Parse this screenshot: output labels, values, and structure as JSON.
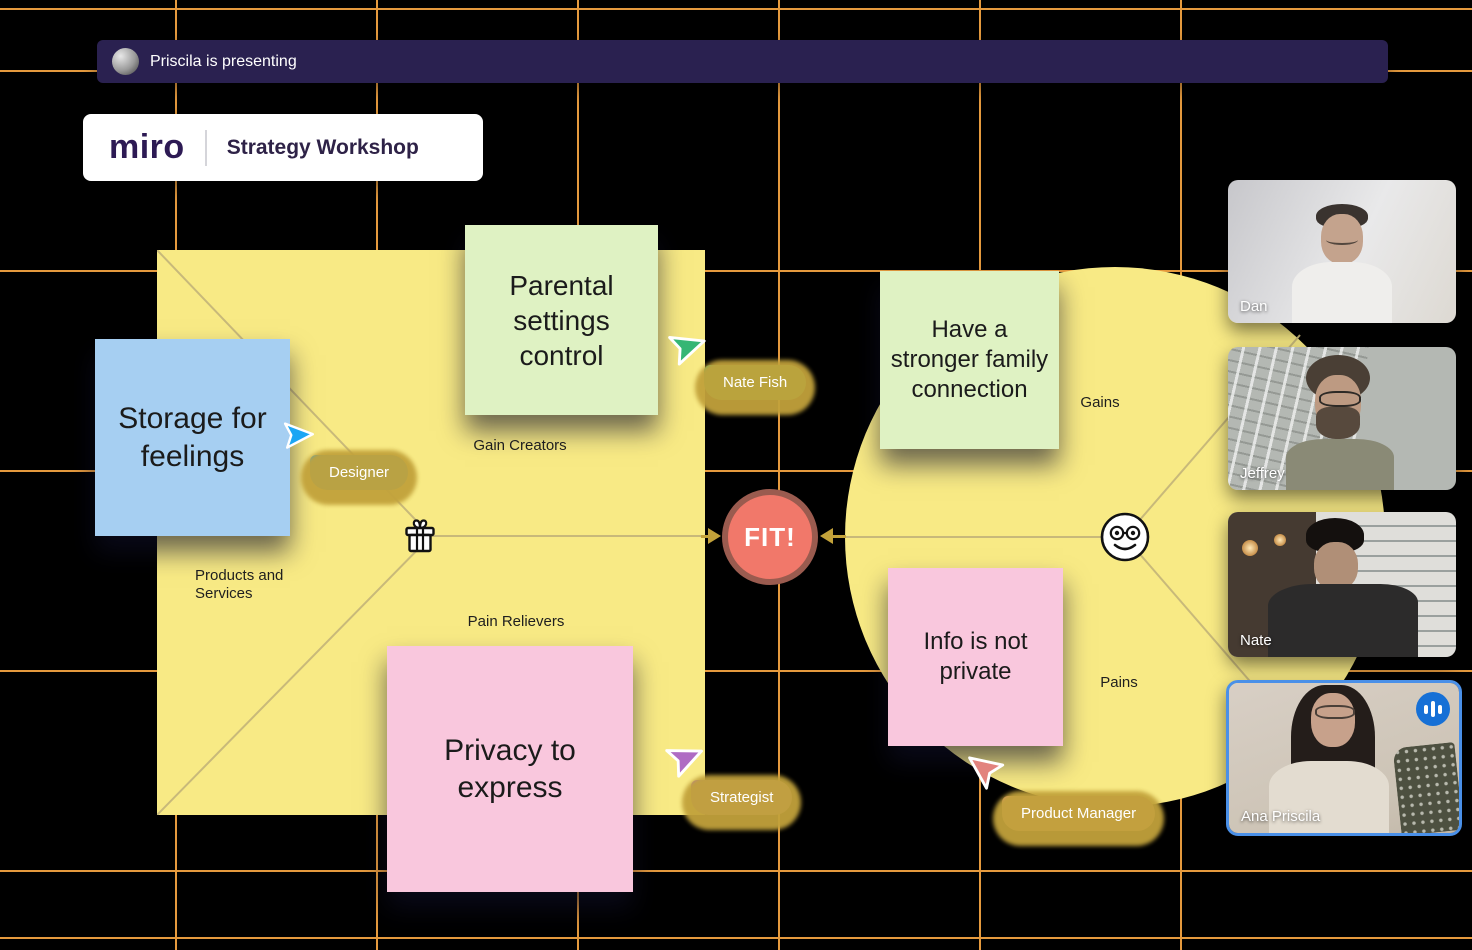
{
  "banner": {
    "text": "Priscila is presenting"
  },
  "logo": {
    "brand": "miro",
    "workshop_title": "Strategy Workshop"
  },
  "canvas": {
    "fit_label": "FIT!",
    "square_labels": {
      "top": "Gain Creators",
      "left": "Products and Services",
      "bottom": "Pain Relievers"
    },
    "circle_labels": {
      "gains": "Gains",
      "pains": "Pains"
    },
    "colors": {
      "board_yellow": "#F8EA85",
      "divider_line": "#C8B97A",
      "fit_fill": "#F1786A",
      "fit_border": "#9A5B4F",
      "arrow": "#C3A23A"
    }
  },
  "stickies": [
    {
      "text": "Storage for feelings",
      "color": "#A6CFF2"
    },
    {
      "text": "Parental settings control",
      "color": "#DFF2C3"
    },
    {
      "text": "Have a stronger family connection",
      "color": "#DFF2C3"
    },
    {
      "text": "Privacy to express",
      "color": "#F9C7DD"
    },
    {
      "text": "Info is not private",
      "color": "#F9C7DD"
    }
  ],
  "cursors": [
    {
      "label": "Designer",
      "color": "#1BA6F4"
    },
    {
      "label": "Nate Fish",
      "color": "#35B674"
    },
    {
      "label": "Strategist",
      "color": "#AF6CC3"
    },
    {
      "label": "Product Manager",
      "color": "#E2837E"
    }
  ],
  "participants": [
    {
      "name": "Dan"
    },
    {
      "name": "Jeffrey"
    },
    {
      "name": "Nate"
    },
    {
      "name": "Ana Priscila",
      "speaking": true
    }
  ],
  "grid_color": "#E59A3E"
}
